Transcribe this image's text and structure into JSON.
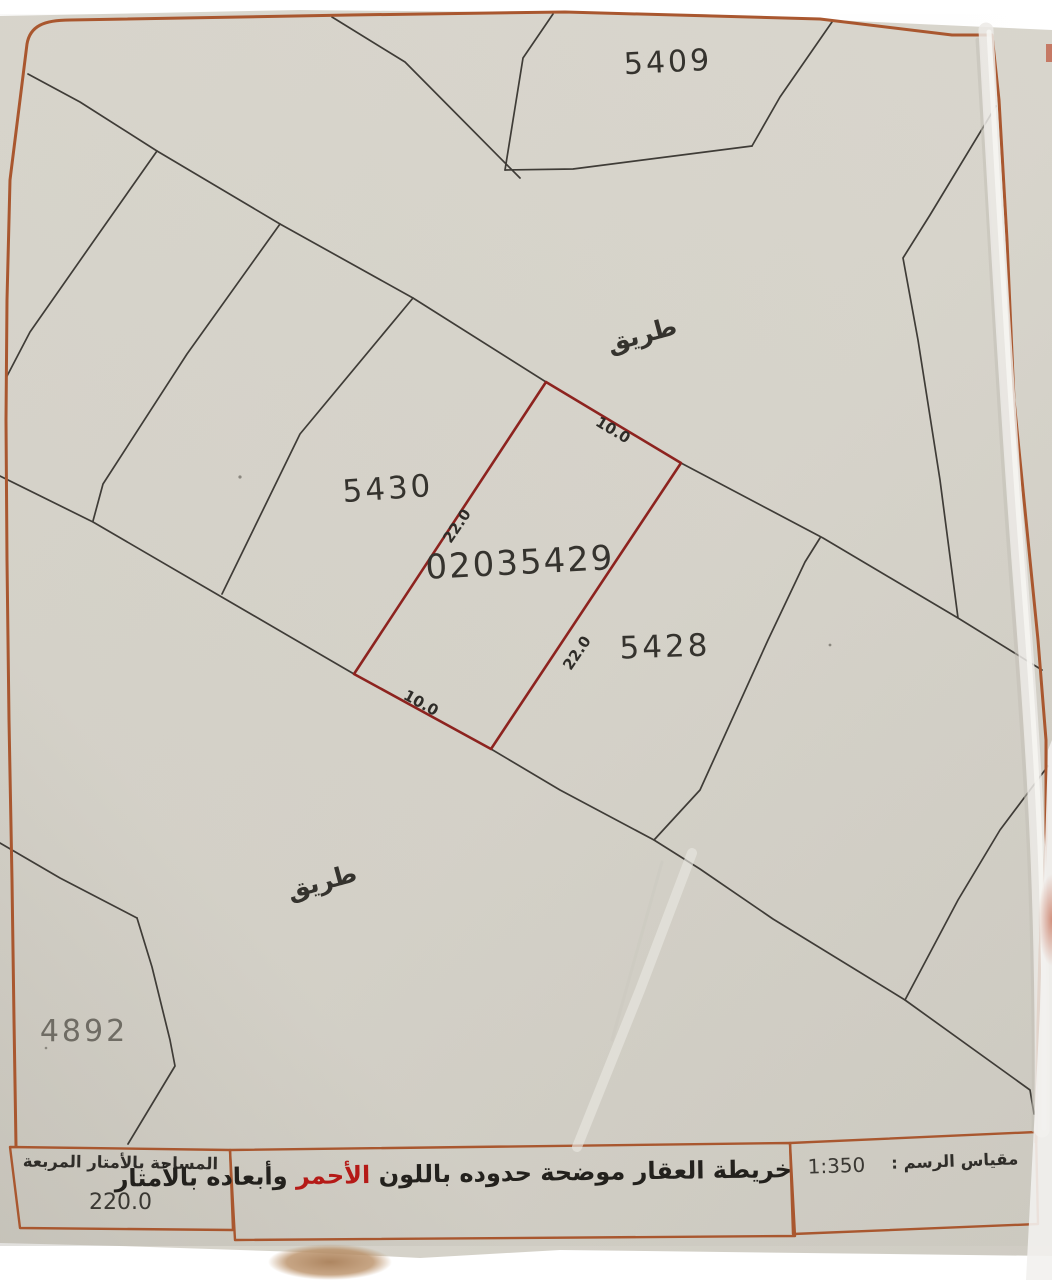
{
  "map": {
    "subject_plot": {
      "number": "02035429",
      "boundary_color": "#8d231f",
      "dimensions": {
        "top": "10.0",
        "right": "22.0",
        "bottom": "10.0",
        "left": "22.0"
      }
    },
    "neighbor_plots": [
      {
        "number": "5409"
      },
      {
        "number": "5430"
      },
      {
        "number": "5428"
      },
      {
        "number": "4892"
      }
    ],
    "road_labels": [
      {
        "text": "طريق"
      },
      {
        "text": "طريق"
      }
    ]
  },
  "legend": {
    "area_box": {
      "label": "المساحة بالأمتار المربعة",
      "value": "220.0"
    },
    "note_box": {
      "text_before": "خريطة العقار موضحة حدوده باللون",
      "highlight": "الأحمر",
      "text_after": "وأبعاده بالأمتار",
      "highlight_color": "#b51a17"
    },
    "scale_box": {
      "label": "مقياس الرسم :",
      "value": "1:350"
    }
  },
  "colors": {
    "paper": "#d8d5cc",
    "frame_border": "#a9572f",
    "plot_line": "#3f3c37",
    "subject_boundary": "#8d231f"
  }
}
